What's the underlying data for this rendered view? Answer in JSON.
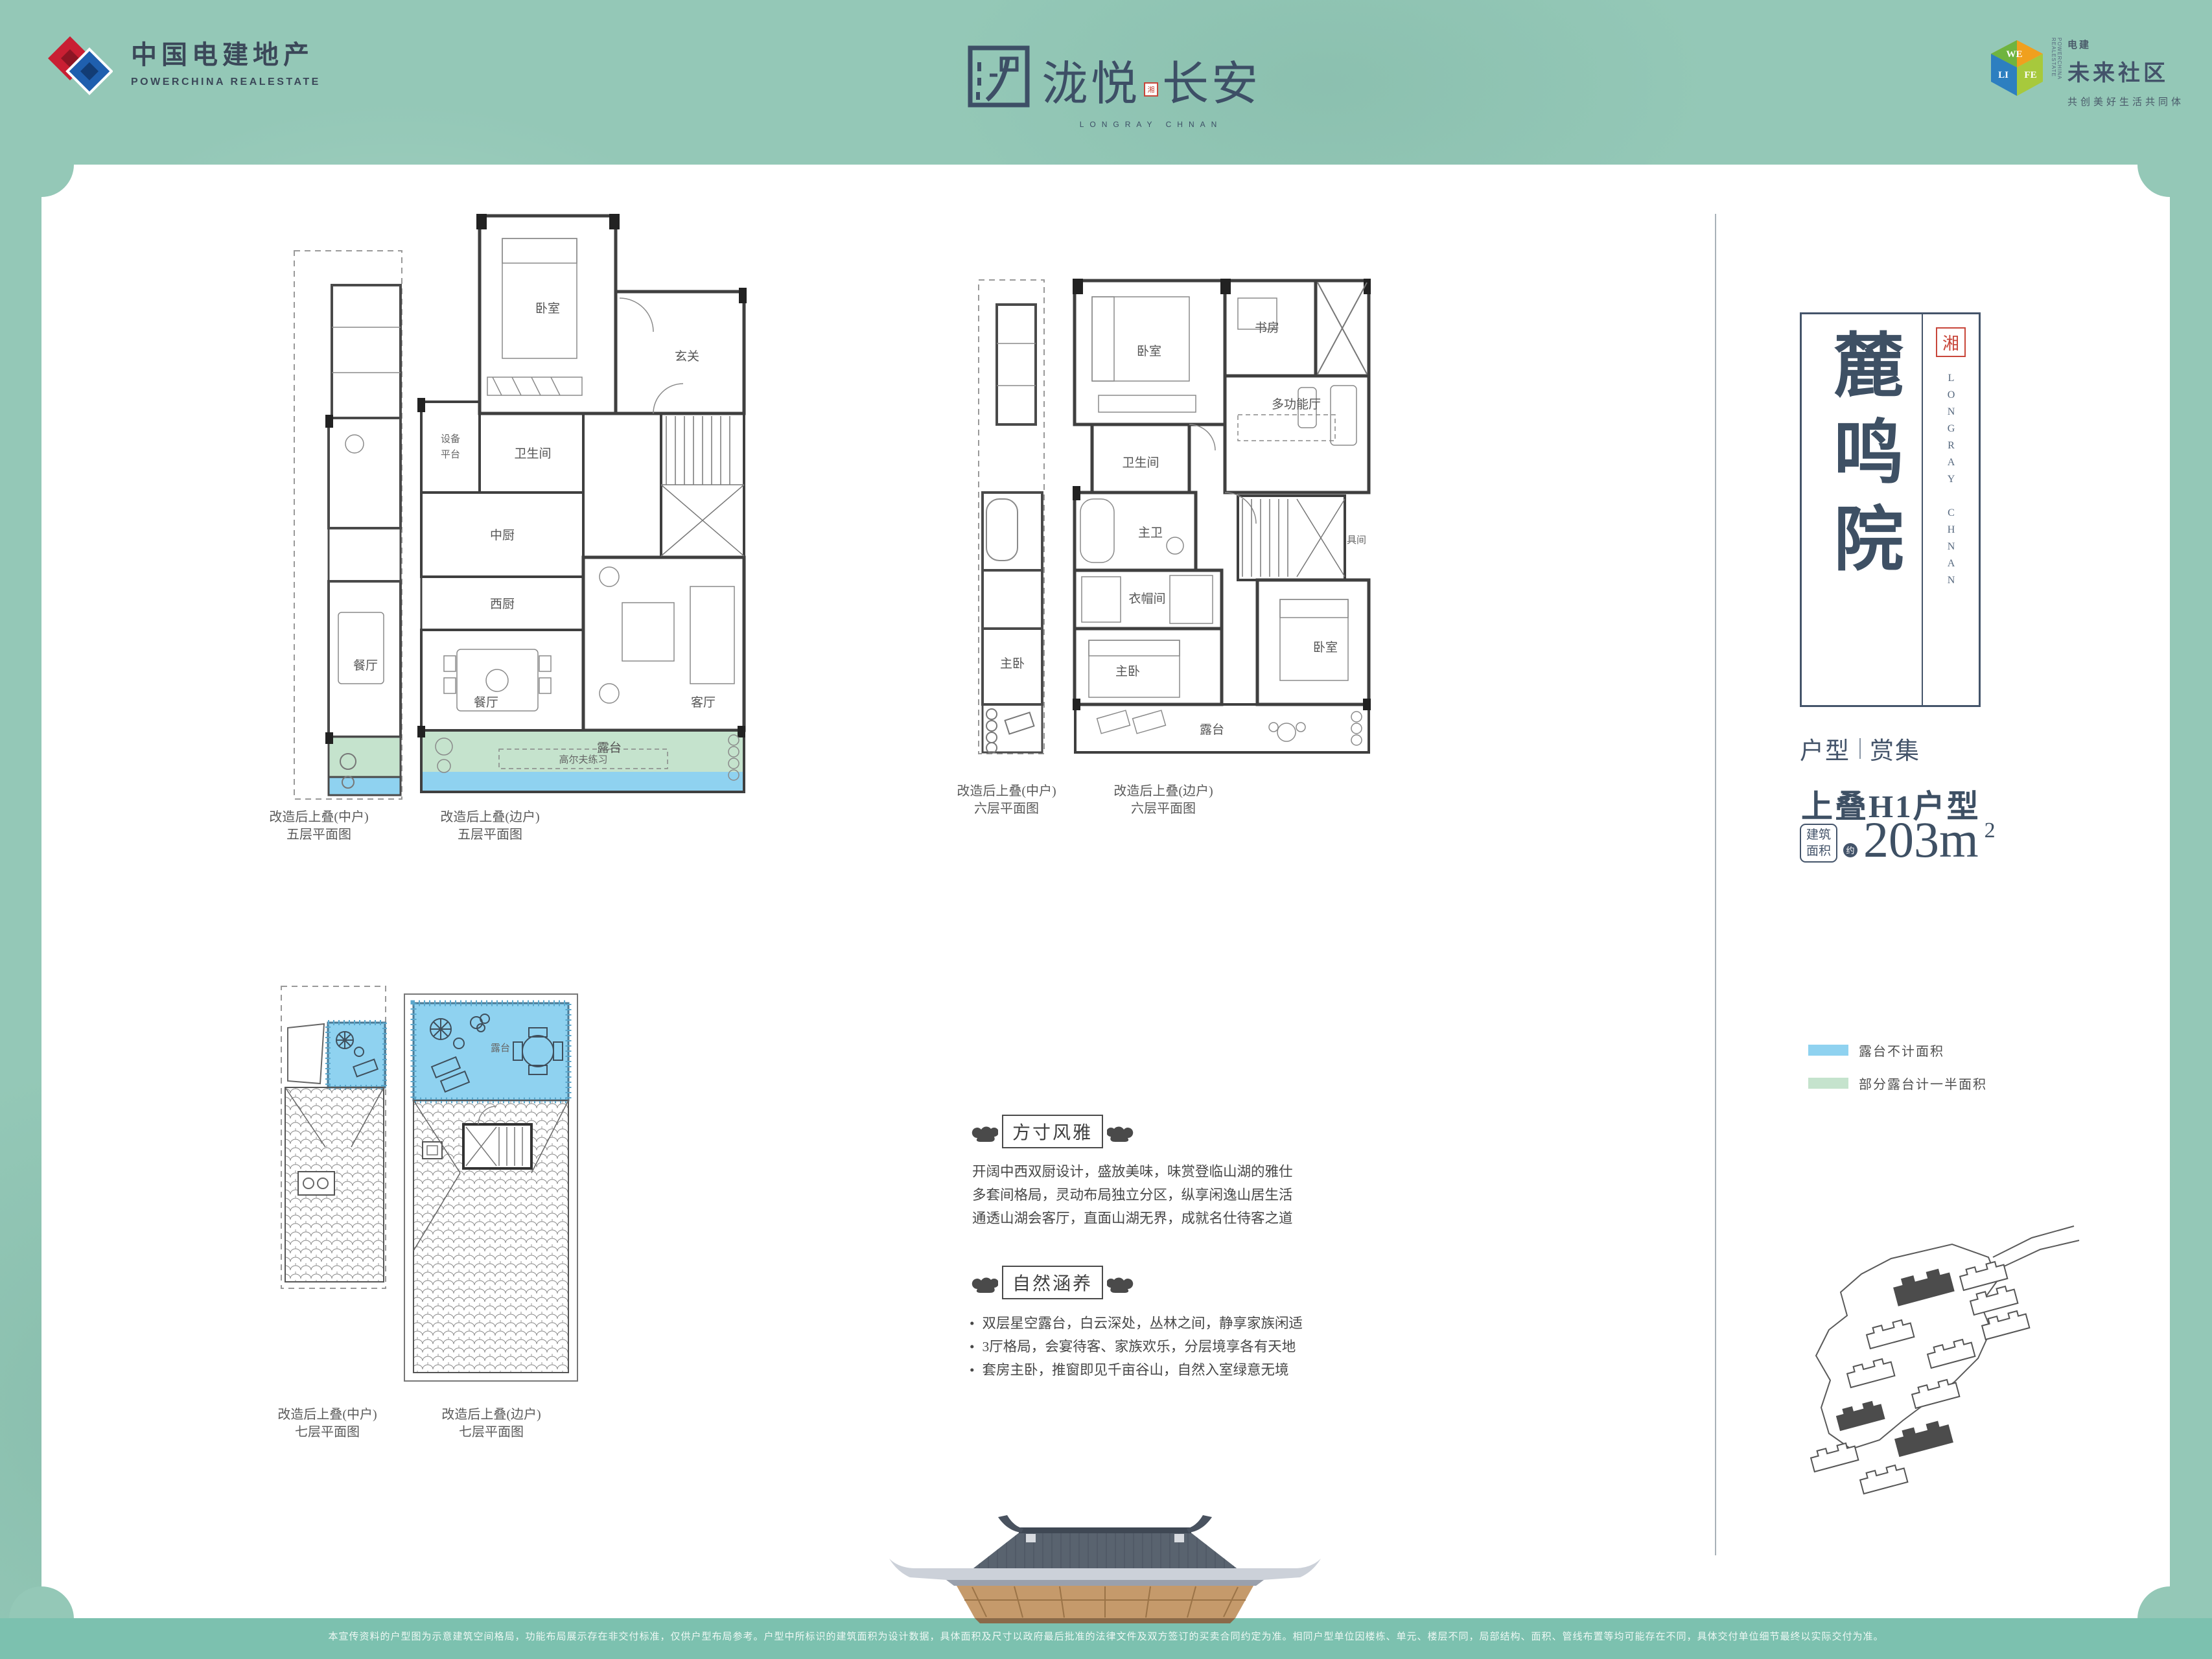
{
  "colors": {
    "accent_navy": "#3e5064",
    "terrace_blue": "#8fd2f0",
    "terrace_green": "#c5e3cd",
    "strip_teal": "#7cc1af",
    "seal_red": "#c8463a",
    "background_teal": "#94c8b7"
  },
  "header": {
    "powerchina": {
      "name_cn": "中国电建地产",
      "name_en": "POWERCHINA REALESTATE"
    },
    "brand": {
      "left": "泷悦",
      "seal": "湘",
      "right": "长安",
      "en": "LONGRAY CHNAN"
    },
    "welife": {
      "cube": [
        "WE",
        "LI",
        "FE"
      ],
      "vertical": "POWERCHINA REALESTATE",
      "small": "电建",
      "big": "未来社区",
      "slogan": "共创美好生活共同体"
    }
  },
  "plans": {
    "f5": {
      "label_mid_1": "改造后上叠(中户)",
      "label_mid_2": "五层平面图",
      "label_edge_1": "改造后上叠(边户)",
      "label_edge_2": "五层平面图",
      "rooms": {
        "bedroom": "卧室",
        "foyer": "玄关",
        "bath": "卫生间",
        "equip1": "设备",
        "equip2": "平台",
        "ckitchen": "中厨",
        "wkitchen": "西厨",
        "dining": "餐厅",
        "living": "客厅",
        "terrace": "露台",
        "golf": "高尔夫练习",
        "dining_mid": "餐厅"
      }
    },
    "f6": {
      "label_mid_1": "改造后上叠(中户)",
      "label_mid_2": "六层平面图",
      "label_edge_1": "改造后上叠(边户)",
      "label_edge_2": "六层平面图",
      "rooms": {
        "bedroom": "卧室",
        "study": "书房",
        "bath": "卫生间",
        "multi": "多功能厅",
        "mbath": "主卫",
        "closet": "衣帽间",
        "master": "主卧",
        "bedroom2": "卧室",
        "tool": "具间",
        "terrace": "露台",
        "master_mid": "主卧"
      }
    },
    "f7": {
      "label_mid_1": "改造后上叠(中户)",
      "label_mid_2": "七层平面图",
      "label_edge_1": "改造后上叠(边户)",
      "label_edge_2": "七层平面图",
      "rooms": {
        "terrace": "露台"
      }
    }
  },
  "sections": {
    "elegance": {
      "title": "方寸风雅",
      "lines": [
        "开阔中西双厨设计，盛放美味，味赏登临山湖的雅仕",
        "多套间格局，灵动布局独立分区，纵享闲逸山居生活",
        "通透山湖会客厅，直面山湖无界，成就名仕待客之道"
      ]
    },
    "nature": {
      "title": "自然涵养",
      "bullets": [
        "双层星空露台，白云深处，丛林之间，静享家族闲适",
        "3厅格局，会宴待客、家族欢乐，分层境享各有天地",
        "套房主卧，推窗即见千亩谷山，自然入室绿意无境"
      ]
    }
  },
  "panel": {
    "plaque": {
      "title": "麓鸣院",
      "seal": "湘",
      "en": "LONGRAY CHNAN"
    },
    "series_l": "户型",
    "series_r": "赏集",
    "unit": "上叠H1户型",
    "area_box_1": "建筑",
    "area_box_2": "面积",
    "approx": "约",
    "area_num": "203m",
    "area_sup": "2",
    "legend": [
      {
        "label": "露台不计面积"
      },
      {
        "label": "部分露台计一半面积"
      }
    ]
  },
  "footer": {
    "disclaimer": "本宣传资料的户型图为示意建筑空间格局，功能布局展示存在非交付标准，仅供户型布局参考。户型中所标识的建筑面积为设计数据，具体面积及尺寸以政府最后批准的法律文件及双方签订的买卖合同约定为准。相同户型单位因楼栋、单元、楼层不同，局部结构、面积、管线布置等均可能存在不同，具体交付单位细节最终以实际交付为准。"
  }
}
